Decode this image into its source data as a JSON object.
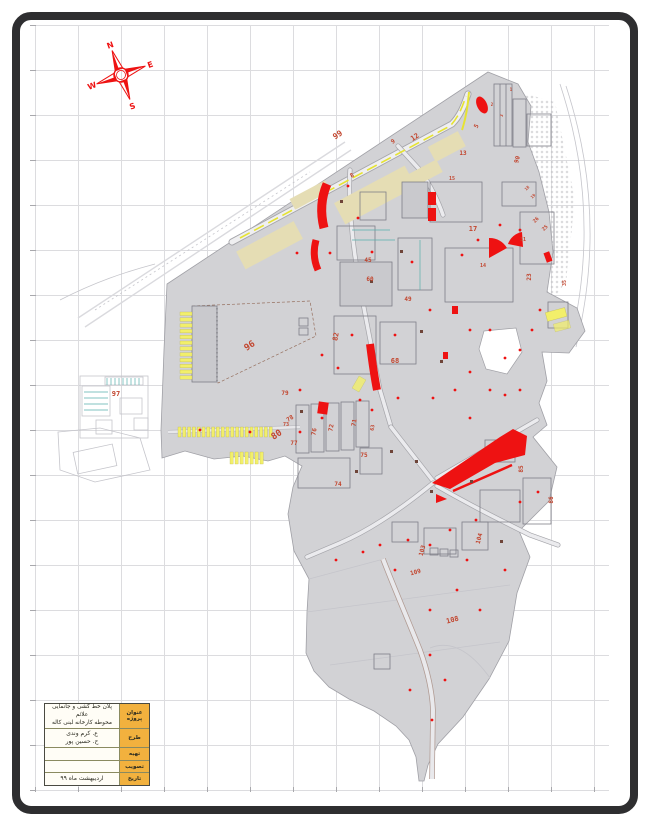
{
  "compass": {
    "n": "N",
    "e": "E",
    "s": "S",
    "w": "W"
  },
  "title_block": {
    "rows": [
      {
        "label": "عنوان پروژه",
        "value": "پلان خط کشی و جانمایی علائم\nمحوطه کارخانه لبنی کاله"
      },
      {
        "label": "طرح",
        "value": "ع. کرم وندی\nح. حسین پور"
      },
      {
        "label": "تهیه",
        "value": ""
      },
      {
        "label": "تصویب",
        "value": ""
      },
      {
        "label": "تاریخ",
        "value": "اردیبهشت ماه ۹۹"
      }
    ]
  },
  "map": {
    "colors": {
      "highlight_red": "#ee1212",
      "label_red": "#c2452e",
      "parking_yellow": "#f2ef6a",
      "zone_beige": "#e5ddb4",
      "site_gray": "#d2d2d5",
      "titleblock_amber": "#f2b13e"
    },
    "parcel_labels": [
      {
        "t": "99",
        "x": 339,
        "y": 137,
        "s": 8,
        "r": -33
      },
      {
        "t": "9",
        "x": 394,
        "y": 143,
        "s": 6,
        "r": -33
      },
      {
        "t": "12",
        "x": 416,
        "y": 139,
        "s": 7,
        "r": -33
      },
      {
        "t": "5",
        "x": 478,
        "y": 127,
        "s": 6,
        "r": -60
      },
      {
        "t": "8",
        "x": 353,
        "y": 177,
        "s": 6,
        "r": -33
      },
      {
        "t": "13",
        "x": 463,
        "y": 155,
        "s": 6,
        "r": 0
      },
      {
        "t": "90",
        "x": 519,
        "y": 160,
        "s": 6,
        "r": -75
      },
      {
        "t": "1",
        "x": 511,
        "y": 91,
        "s": 4,
        "r": 0
      },
      {
        "t": "2",
        "x": 492,
        "y": 106,
        "s": 4,
        "r": 0
      },
      {
        "t": "3",
        "x": 503,
        "y": 116,
        "s": 4,
        "r": -75
      },
      {
        "t": "17",
        "x": 473,
        "y": 231,
        "s": 7,
        "r": 0
      },
      {
        "t": "15",
        "x": 452,
        "y": 180,
        "s": 5,
        "r": 0
      },
      {
        "t": "25",
        "x": 546,
        "y": 229,
        "s": 5,
        "r": -45
      },
      {
        "t": "26",
        "x": 537,
        "y": 221,
        "s": 5,
        "r": -45
      },
      {
        "t": "31",
        "x": 523,
        "y": 241,
        "s": 5,
        "r": 0
      },
      {
        "t": "23",
        "x": 531,
        "y": 277,
        "s": 6,
        "r": -90
      },
      {
        "t": "35",
        "x": 566,
        "y": 283,
        "s": 5,
        "r": -90
      },
      {
        "t": "14",
        "x": 483,
        "y": 267,
        "s": 5,
        "r": 0
      },
      {
        "t": "18",
        "x": 528,
        "y": 189,
        "s": 4,
        "r": -45
      },
      {
        "t": "19",
        "x": 534,
        "y": 197,
        "s": 4,
        "r": -45
      },
      {
        "t": "45",
        "x": 368,
        "y": 262,
        "s": 6,
        "r": 0
      },
      {
        "t": "60",
        "x": 370,
        "y": 281,
        "s": 6,
        "r": 0
      },
      {
        "t": "49",
        "x": 408,
        "y": 301,
        "s": 6,
        "r": 0
      },
      {
        "t": "82",
        "x": 338,
        "y": 337,
        "s": 7,
        "r": -80
      },
      {
        "t": "68",
        "x": 395,
        "y": 363,
        "s": 7,
        "r": 0
      },
      {
        "t": "96",
        "x": 251,
        "y": 348,
        "s": 9,
        "r": -33
      },
      {
        "t": "97",
        "x": 116,
        "y": 396,
        "s": 7,
        "r": 0
      },
      {
        "t": "80",
        "x": 278,
        "y": 437,
        "s": 9,
        "r": -33
      },
      {
        "t": "78",
        "x": 291,
        "y": 420,
        "s": 6,
        "r": -33
      },
      {
        "t": "79",
        "x": 285,
        "y": 395,
        "s": 6,
        "r": 0
      },
      {
        "t": "73",
        "x": 286,
        "y": 426,
        "s": 5,
        "r": 0
      },
      {
        "t": "76",
        "x": 316,
        "y": 432,
        "s": 6,
        "r": -80
      },
      {
        "t": "72",
        "x": 333,
        "y": 428,
        "s": 6,
        "r": -80
      },
      {
        "t": "71",
        "x": 356,
        "y": 423,
        "s": 6,
        "r": -80
      },
      {
        "t": "63",
        "x": 374,
        "y": 428,
        "s": 5,
        "r": -80
      },
      {
        "t": "77",
        "x": 294,
        "y": 445,
        "s": 6,
        "r": 0
      },
      {
        "t": "75",
        "x": 364,
        "y": 457,
        "s": 6,
        "r": 0
      },
      {
        "t": "74",
        "x": 338,
        "y": 486,
        "s": 6,
        "r": 0
      },
      {
        "t": "85",
        "x": 523,
        "y": 469,
        "s": 6,
        "r": -90
      },
      {
        "t": "86",
        "x": 553,
        "y": 500,
        "s": 6,
        "r": -90
      },
      {
        "t": "103",
        "x": 424,
        "y": 551,
        "s": 6,
        "r": -75
      },
      {
        "t": "104",
        "x": 481,
        "y": 539,
        "s": 6,
        "r": -75
      },
      {
        "t": "109",
        "x": 416,
        "y": 574,
        "s": 6,
        "r": -15
      },
      {
        "t": "108",
        "x": 453,
        "y": 622,
        "s": 7,
        "r": -15
      }
    ]
  }
}
